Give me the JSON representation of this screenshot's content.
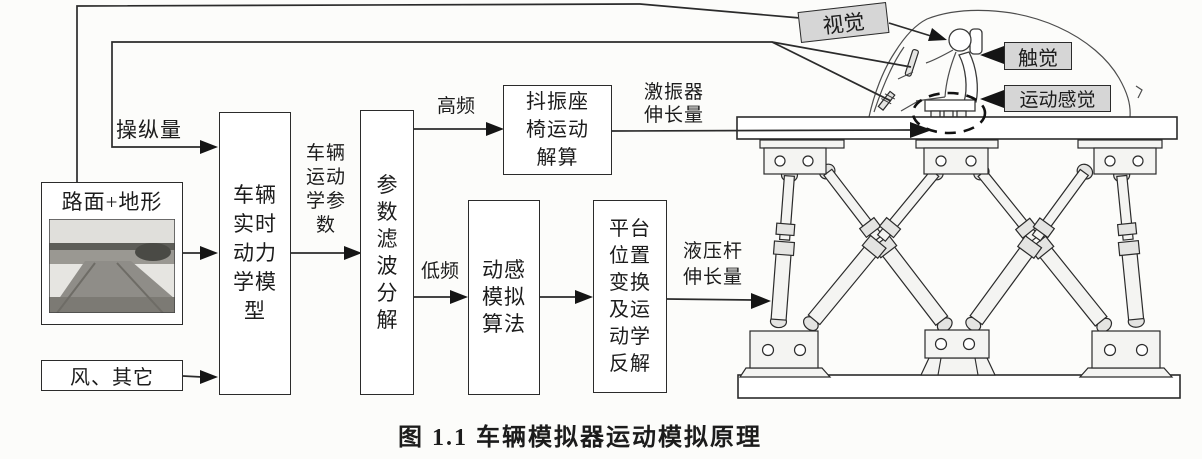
{
  "caption": "图 1.1 车辆模拟器运动模拟原理",
  "boxes": {
    "road_terrain": {
      "title": "路面+地形",
      "photo": "grayscale-road-scene-photo"
    },
    "wind": {
      "label": "风、其它"
    },
    "vehicle_model": {
      "full": "车辆实时动力学模型",
      "lines": [
        "车辆",
        "实时",
        "动力",
        "学模",
        "型"
      ]
    },
    "param_filter": {
      "full": "参数滤波分解",
      "lines": [
        "参",
        "数",
        "滤",
        "波",
        "分",
        "解"
      ]
    },
    "seat_calc": {
      "full": "抖振座椅运动解算",
      "lines": [
        "抖振座",
        "椅运动",
        "解算"
      ]
    },
    "motion_sim": {
      "full": "动感模拟算法",
      "lines": [
        "动感",
        "模拟",
        "算法"
      ]
    },
    "platform_solve": {
      "full": "平台位置变换及运动学反解",
      "lines": [
        "平台",
        "位置",
        "变换",
        "及运",
        "动学",
        "反解"
      ]
    }
  },
  "signals": {
    "control": "操纵量",
    "vehicle_kinematics": {
      "full": "车辆运动学参数",
      "lines": [
        "车辆",
        "运动",
        "学参",
        "数"
      ]
    },
    "high_freq": "高频",
    "low_freq": "低频",
    "exciter_elongation": {
      "full": "激振器伸长量",
      "lines": [
        "激振器",
        "伸长量"
      ]
    },
    "hydraulic_elongation": {
      "full": "液压杆伸长量",
      "lines": [
        "液压杆",
        "伸长量"
      ]
    }
  },
  "sensory": {
    "vision": "视觉",
    "touch": "触觉",
    "motion_feel": "运动感觉"
  },
  "illustration": {
    "platform": "six-leg-stewart-motion-platform",
    "vehicle": "car-cabin-with-driver-sketch",
    "seat_shaker": "buffeting-seat-exciter-dashed-circle"
  },
  "colors": {
    "line": "#2b2b2b",
    "box_fill": "#ffffff",
    "sensory_box_fill": "#d6d6d6",
    "background": "#fcfcfa"
  }
}
